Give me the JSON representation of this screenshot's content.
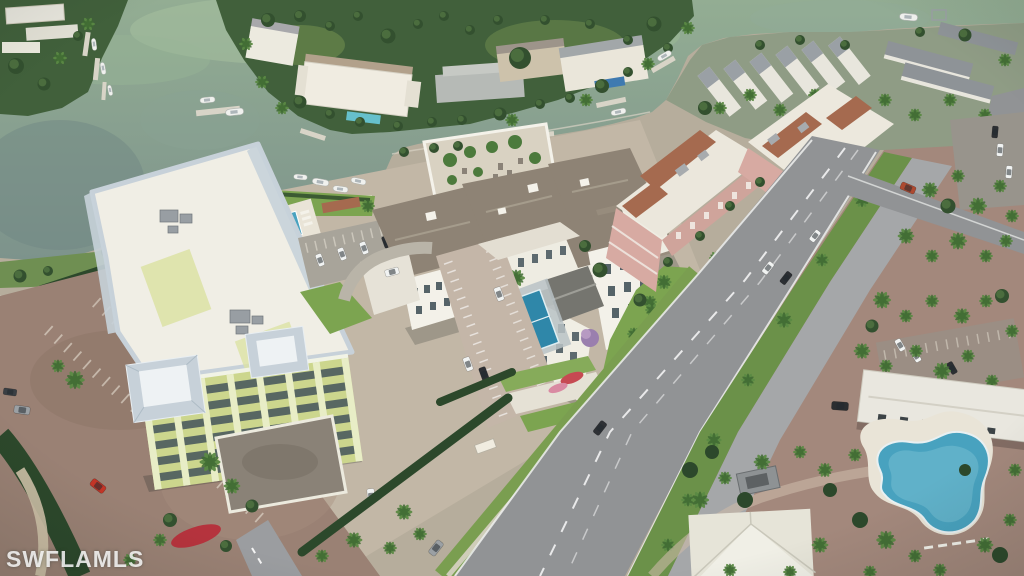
{
  "scene": {
    "description": "Aerial rendering of a waterfront residential development: condo buildings, canals with boat docks, palm-lined boulevard, parking lots, pools and tropical landscaping",
    "watermark": "SWFLAMLS"
  },
  "palette": {
    "water": "#81988d",
    "waterLight": "#a7c1a0",
    "waterDark": "#6f8683",
    "veg": "#41603b",
    "tree": "#4e7040",
    "treeDark": "#33502f",
    "palmLeaf": "#5b8a44",
    "palmLeafDark": "#3f6a33",
    "lawn": "#7ca450",
    "lawnMedian": "#6b9149",
    "hedge": "#2c482b",
    "ground": "#b6ad9c",
    "paver": "#9a8174",
    "paverPink": "#c4b6a8",
    "paverRight": "#a3887c",
    "road": "#919395",
    "roadLight": "#a5a7a9",
    "concrete": "#e7e3d8",
    "deck": "#e9e4d7",
    "roofWhite": "#f0eee5",
    "roofTaupe": "#8e8375",
    "roofGray": "#9aa0a5",
    "roofMetal": "#c7d1d9",
    "roofTerra": "#a56a4f",
    "wallWhite": "#f3f1e9",
    "wallPink": "#d7aaa2",
    "wallGreen": "#ccd68d",
    "windowDark": "#44545b",
    "pool": "#48a2bf",
    "court": "#2f87a9",
    "carWhite": "#f1f3f2",
    "carDark": "#2c2f33",
    "carRed": "#c23527",
    "carGray": "#9ba0a4",
    "truckRed": "#ad4a31",
    "boat": "#f0f1ee",
    "dock": "#d8d4c7",
    "watermark": "rgba(255,255,255,0.82)"
  }
}
